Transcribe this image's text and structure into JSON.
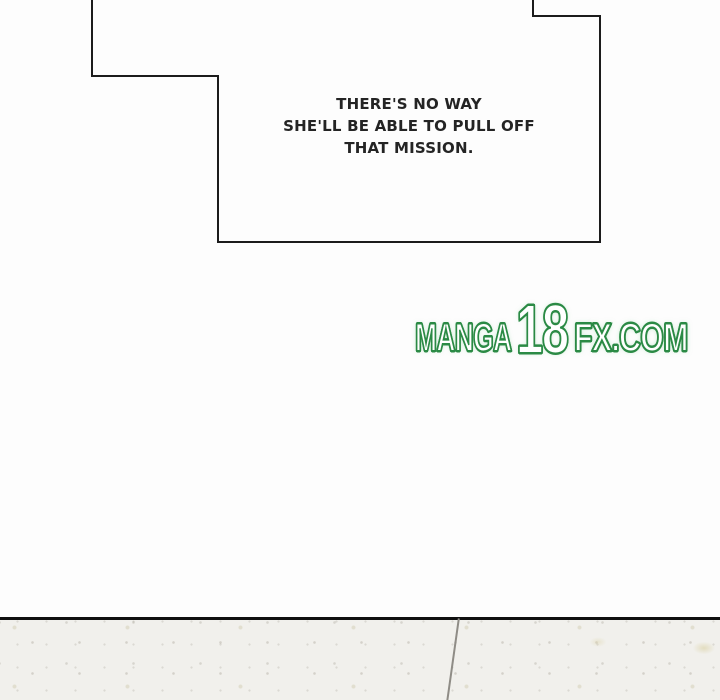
{
  "panel": {
    "speech_bubble": {
      "line1": "THERE'S NO WAY",
      "line2": "SHE'LL BE ABLE TO PULL OFF",
      "line3": "THAT MISSION."
    },
    "watermark": {
      "part_manga": "MANGA",
      "part_18": "18",
      "part_fx": "FX.COM",
      "full_text": "MANGA18FX.COM",
      "outline_color": "#2b8a45"
    },
    "colors": {
      "page_background": "#fdfdfd",
      "bubble_border": "#1c1c1c",
      "bubble_text": "#242424",
      "floor_divider": "#0f0f0f",
      "floor_background": "#f1f0ec",
      "floor_seam": "#8f8c86"
    }
  }
}
